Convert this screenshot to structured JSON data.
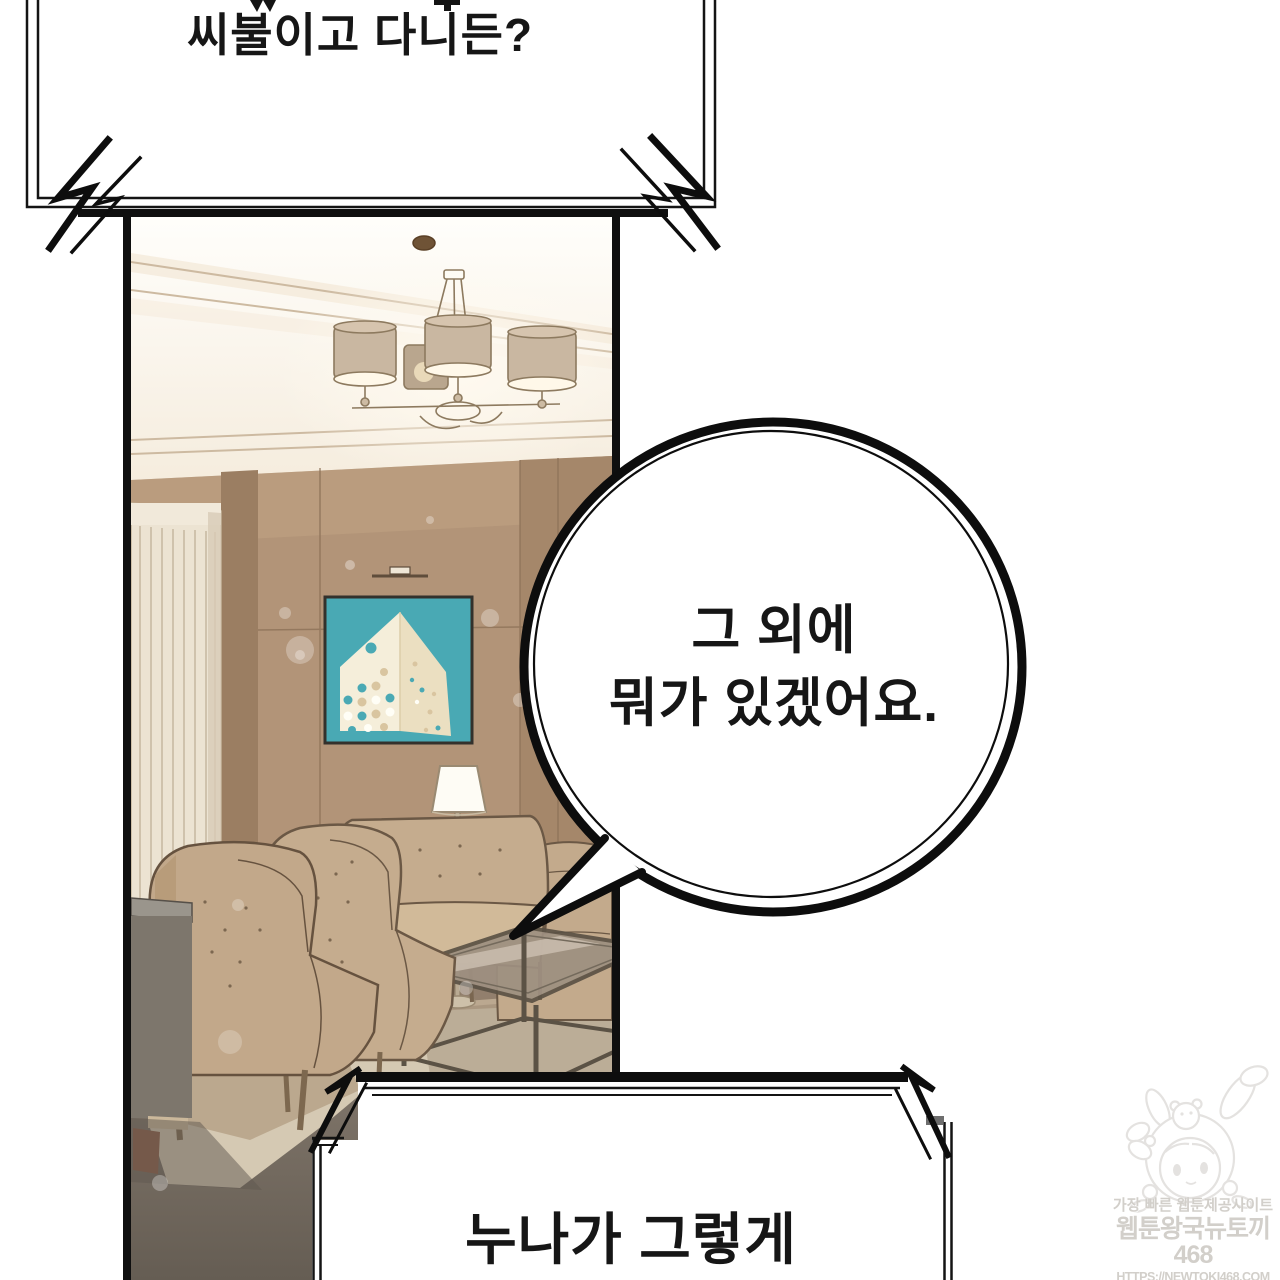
{
  "comic": {
    "bubbles": {
      "top_shout": {
        "line": "씨불이고 다니든?"
      },
      "round": {
        "line1": "그 외에",
        "line2": "뭐가 있겠어요."
      },
      "bottom_shout": {
        "line": "누나가 그렇게"
      }
    },
    "watermark": {
      "tagline": "가장 빠른 웹툰제공사이트",
      "site_name": "웹툰왕국뉴토끼468",
      "url": "HTTPS://NEWTOKI468.COM"
    },
    "icons": {
      "impact_mark": "lightning-scribble",
      "mascot": "bunny-hood-girl"
    },
    "colors": {
      "ink": "#111111",
      "wall_brown": "#b29478",
      "painting_teal": "#4aa9b4",
      "furniture_tan": "#c5ac8e",
      "rug_beige": "#d5c9b3",
      "floor_gray": "#85796b",
      "watermark_gray": "#d2cfca"
    }
  }
}
